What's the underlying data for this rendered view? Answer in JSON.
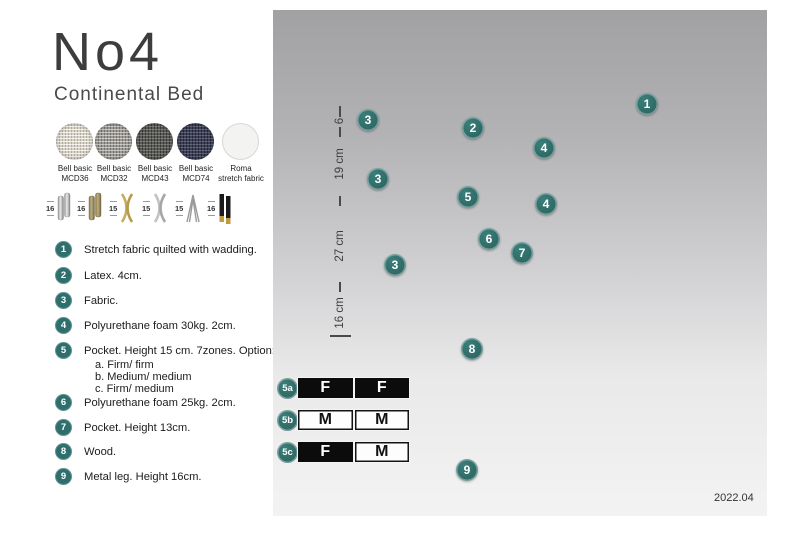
{
  "accent_color": "#2e6f6d",
  "header": {
    "title": "No4",
    "subtitle": "Continental Bed"
  },
  "fabrics": [
    {
      "name": "Bell basic",
      "code": "MCD36"
    },
    {
      "name": "Bell basic",
      "code": "MCD32"
    },
    {
      "name": "Bell basic",
      "code": "MCD43"
    },
    {
      "name": "Bell basic",
      "code": "MCD74"
    },
    {
      "name": "Roma",
      "code": "stretch fabric"
    }
  ],
  "legs": [
    {
      "height": "16",
      "style": "cylinder-silver"
    },
    {
      "height": "16",
      "style": "cylinder-brass"
    },
    {
      "height": "15",
      "style": "cross-gold"
    },
    {
      "height": "15",
      "style": "cross-silver"
    },
    {
      "height": "15",
      "style": "hairpin-silver"
    },
    {
      "height": "16",
      "style": "tapered-black-gold"
    }
  ],
  "parts": [
    {
      "num": "1",
      "text": "Stretch fabric quilted with wadding."
    },
    {
      "num": "2",
      "text": "Latex. 4cm."
    },
    {
      "num": "3",
      "text": "Fabric."
    },
    {
      "num": "4",
      "text": "Polyurethane foam 30kg. 2cm."
    },
    {
      "num": "5",
      "text": "Pocket. Height 15 cm. 7zones. Option:",
      "options": [
        "a. Firm/ firm",
        "b. Medium/ medium",
        "c. Firm/ medium"
      ]
    },
    {
      "num": "6",
      "text": "Polyurethane foam 25kg. 2cm."
    },
    {
      "num": "7",
      "text": "Pocket. Height 13cm."
    },
    {
      "num": "8",
      "text": "Wood."
    },
    {
      "num": "9",
      "text": "Metal leg. Height 16cm."
    }
  ],
  "diagram": {
    "dimensions": {
      "topper": "6",
      "mattress": "19 cm",
      "base": "27 cm",
      "leg": "16 cm"
    },
    "callouts": {
      "c1": "1",
      "c2": "2",
      "c3a": "3",
      "c3b": "3",
      "c3c": "3",
      "c4a": "4",
      "c4b": "4",
      "c5": "5",
      "c6": "6",
      "c7": "7",
      "c8": "8",
      "c9": "9"
    },
    "firmness_options": [
      {
        "id": "5a",
        "cells": [
          {
            "letter": "F",
            "style": "dark"
          },
          {
            "letter": "F",
            "style": "dark"
          }
        ]
      },
      {
        "id": "5b",
        "cells": [
          {
            "letter": "M",
            "style": "light"
          },
          {
            "letter": "M",
            "style": "light"
          }
        ]
      },
      {
        "id": "5c",
        "cells": [
          {
            "letter": "F",
            "style": "dark"
          },
          {
            "letter": "M",
            "style": "light"
          }
        ]
      }
    ],
    "version": "2022.04",
    "colors": {
      "fabric_dark": "#575c64",
      "latex": "#b5ac83",
      "wood": "#d9ba88",
      "spring": "#f1f1ee"
    }
  }
}
